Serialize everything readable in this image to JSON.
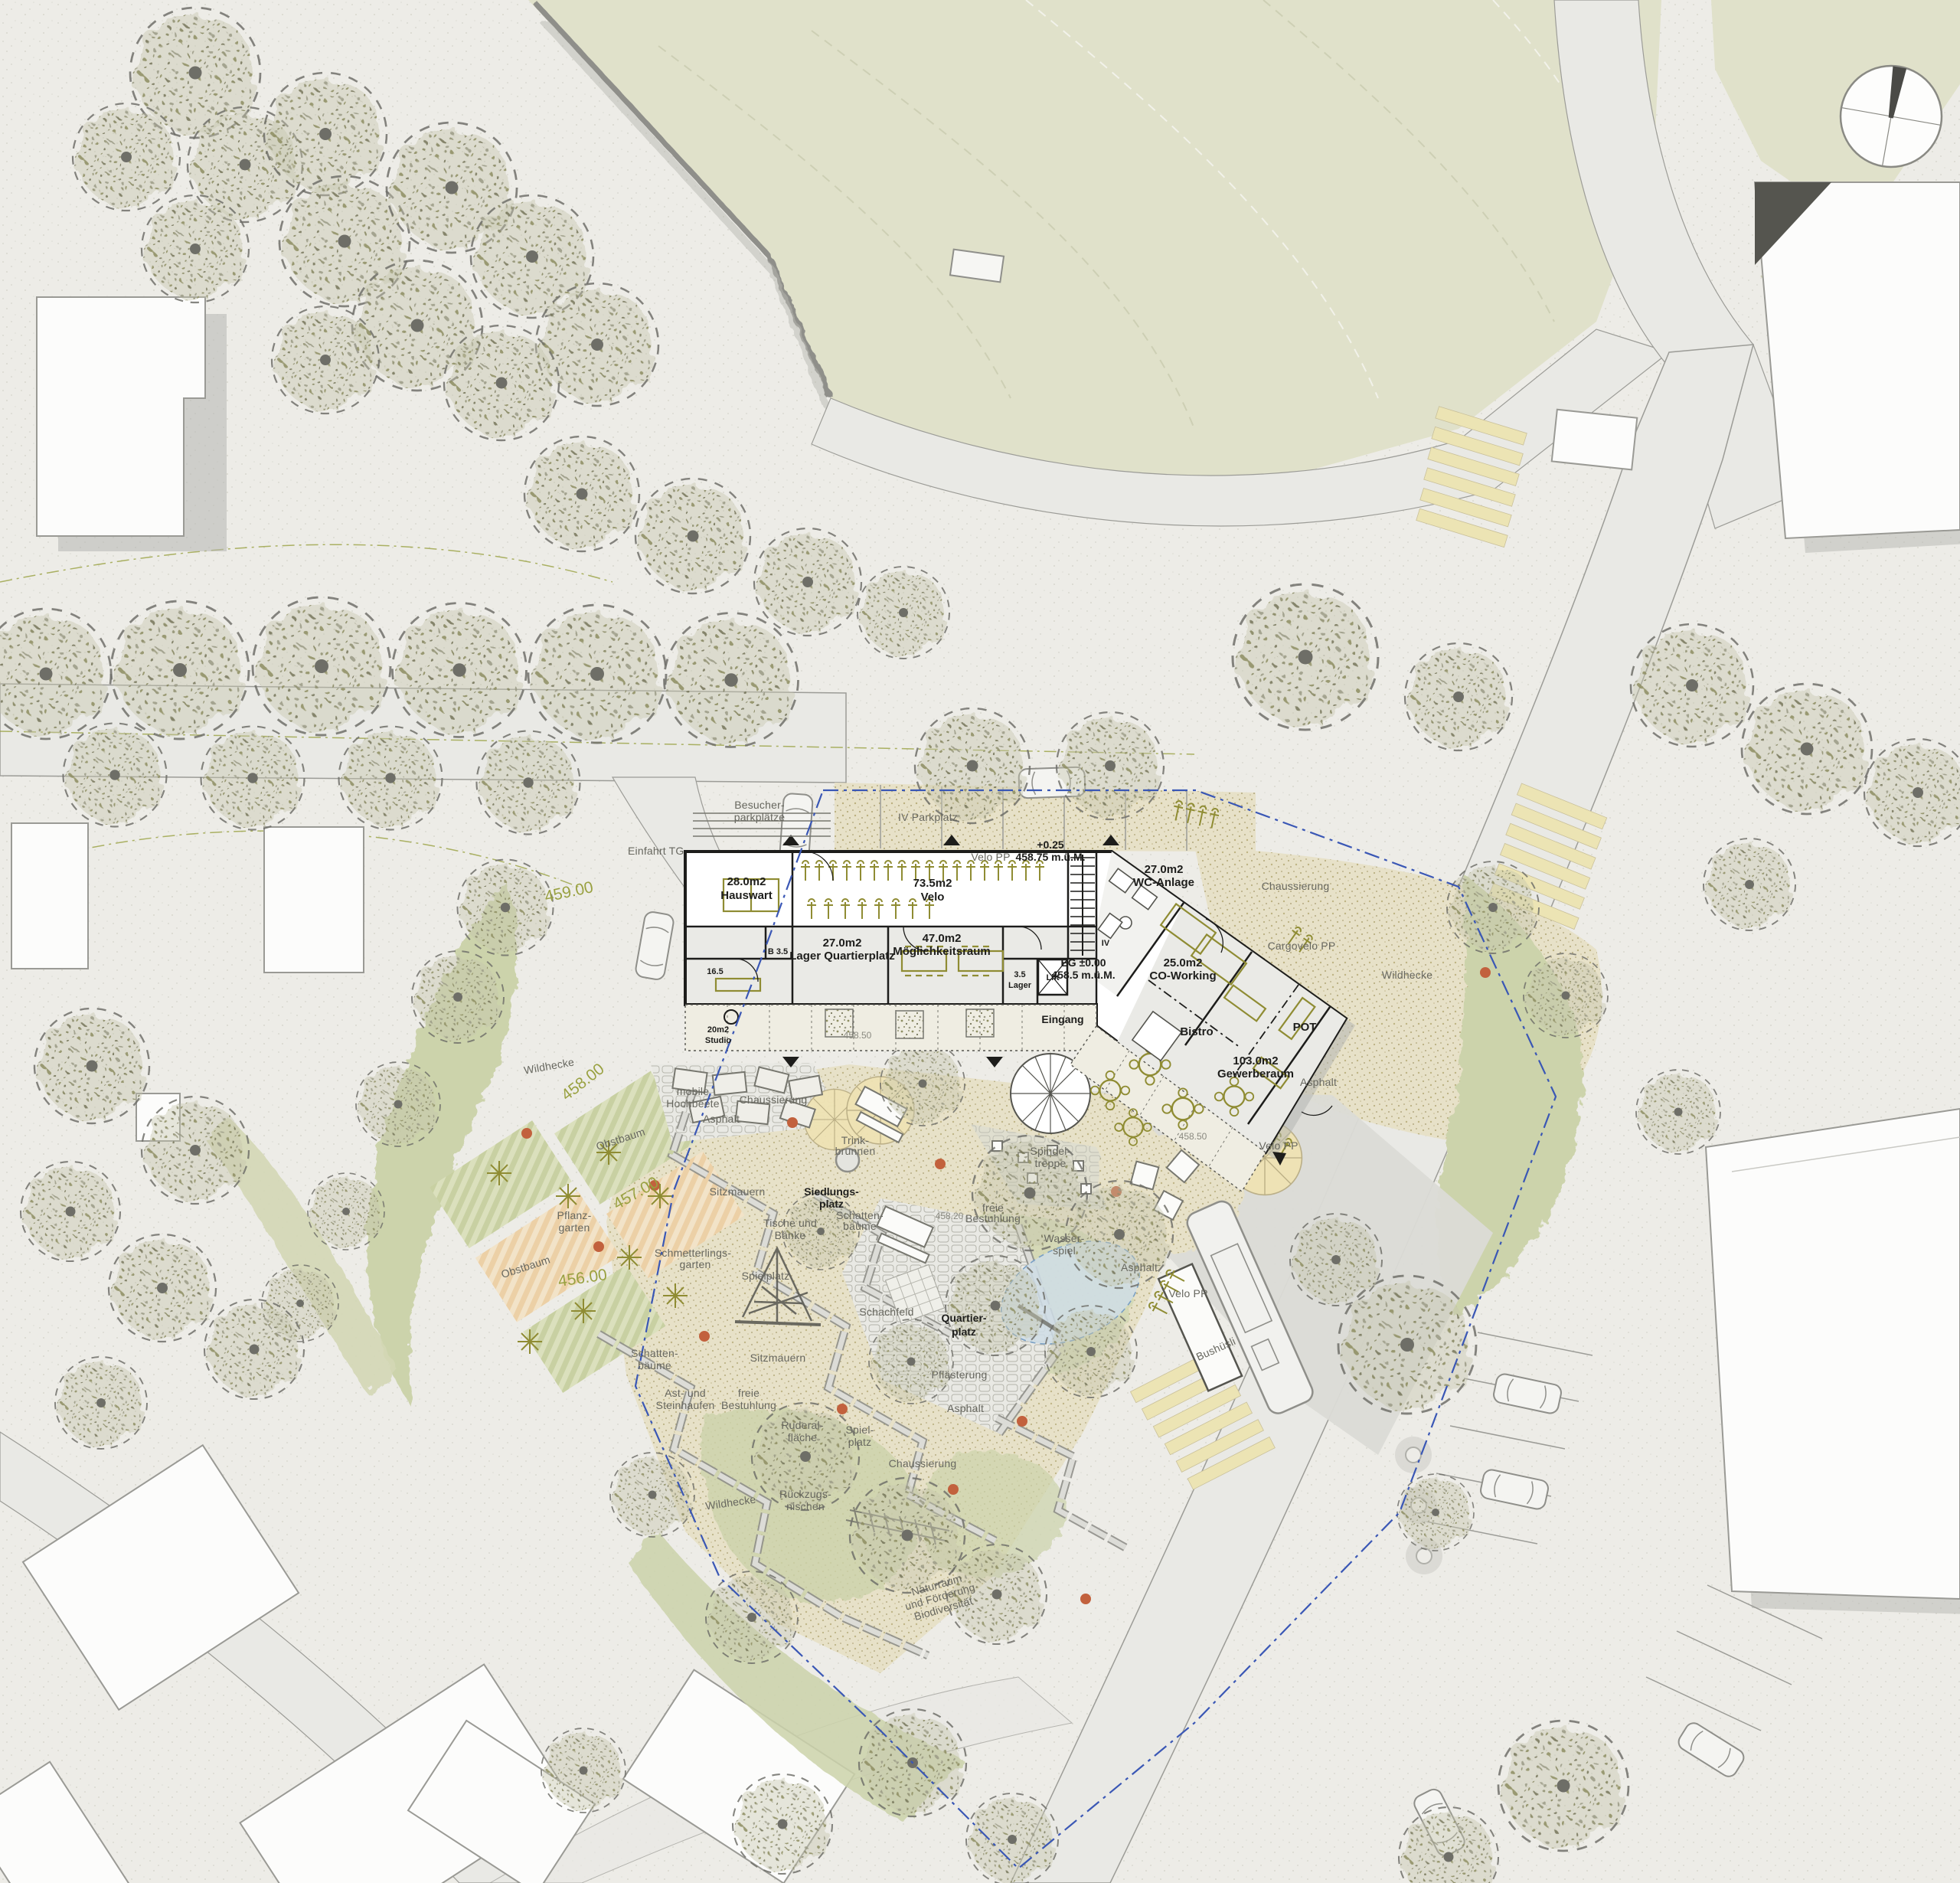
{
  "plan": {
    "icons": {
      "north_arrow": "north-arrow-compass",
      "bus": "bus-top-view",
      "car": "car-top-view",
      "tree": "tree-canopy",
      "parasol": "parasol-umbrella"
    },
    "rooms": {
      "hauswart_area": "28.0m2",
      "hauswart": "Hauswart",
      "velo_area": "73.5m2",
      "velo": "Velo",
      "wc_area": "27.0m2",
      "wc": "WC-Anlage",
      "iv": "IV",
      "lagerq_area": "27.0m2",
      "lagerq": "Lager Quartierplatz",
      "moegl_area": "47.0m2",
      "moegl": "Möglichkeitsraum",
      "bad": "B 3.5",
      "zimmer": "16.5",
      "lager_area": "3.5",
      "lager": "Lager",
      "lift": "Lift",
      "cowork_area": "25.0m2",
      "cowork": "CO-Working",
      "bistro": "Bistro",
      "gewerbe_area": "103.0m2",
      "gewerbe": "Gewerberaum",
      "pot": "POT",
      "studio_area": "20m2",
      "studio": "Studio",
      "eingang": "Eingang",
      "spindel_1": "Spindel-",
      "spindel_2": "treppe",
      "eg_1": "EG ±0.00",
      "eg_2": "458.5 m.ü.M.",
      "entry_1": "+0.25",
      "entry_2": "458.75 m.ü.M."
    },
    "site": {
      "einfahrt_tg": "Einfahrt TG",
      "besucher_1": "Besucher-",
      "besucher_2": "parkplätze",
      "iv_parkplatz": "IV Parkplatz",
      "velo_pp_nord": "Velo PP",
      "velo_pp_ost": "Velo PP",
      "velo_pp_bus": "Velo PP",
      "cargovelo": "Cargovelo PP",
      "bushuesli": "Bushüsli",
      "chaussierung_no": "Chaussierung",
      "chaussierung_w": "Chaussierung",
      "chaussierung_s": "Chaussierung",
      "asphalt_o": "Asphalt",
      "asphalt_w": "Asphalt",
      "asphalt_m": "Asphalt",
      "asphalt_s": "Asphalt",
      "pflaesterung": "Pflästerung",
      "wildhecke_w": "Wildhecke",
      "wildhecke_o": "Wildhecke",
      "wildhecke_s": "Wildhecke",
      "hochbeete_1": "mobile",
      "hochbeete_2": "Hochbeete",
      "obstbaum_1": "Obstbaum",
      "obstbaum_2": "Obstbaum",
      "pflanzgarten_1": "Pflanz-",
      "pflanzgarten_2": "garten",
      "sitzmauern_1": "Sitzmauern",
      "sitzmauern_2": "Sitzmauern",
      "siedlungsplatz_1": "Siedlungs-",
      "siedlungsplatz_2": "platz",
      "tische_1": "Tische und",
      "tische_2": "Bänke",
      "schattenb_1a": "Schatten-",
      "schattenb_1b": "bäume",
      "schattenb_2a": "Schatten-",
      "schattenb_2b": "bäume",
      "schmett_1": "Schmetterlings-",
      "schmett_2": "garten",
      "spielplatz": "Spielplatz",
      "spielplatz2_1": "Spiel-",
      "spielplatz2_2": "platz",
      "schachfeld": "Schachfeld",
      "quartier_1": "Quartier-",
      "quartier_2": "platz",
      "frei_1a": "freie",
      "frei_1b": "Bestuhlung",
      "frei_2a": "freie",
      "frei_2b": "Bestuhlung",
      "ruderal_1": "Ruderal-",
      "ruderal_2": "fläche",
      "rueckzug_1": "Rückzugs-",
      "rueckzug_2": "nischen",
      "ast_1": "Ast- und",
      "ast_2": "Steinhaufen",
      "natur_1": "Naturraum",
      "natur_2": "und Förderung",
      "natur_3": "Biodiversität",
      "trink_1": "Trink-",
      "trink_2": "brunnen",
      "wasser_1": "Wasser-",
      "wasser_2": "spiel"
    },
    "elevations": {
      "c459": "459.00",
      "c458": "458.00",
      "c457": "457.00",
      "c456": "456.00",
      "p458_50a": "458.50",
      "p458_50b": "458.50",
      "p458_20": "458.20"
    },
    "colors": {
      "background": "#edece7",
      "park_green": "#e0e1ca",
      "road_fill": "#e9e9e5",
      "road_edge": "#9c9c97",
      "building_white": "#fcfcfb",
      "shadow_gray": "#b5b6b2",
      "plan_wall": "#1d1d1b",
      "furniture_olive": "#8f8c33",
      "sand": "#e7e1c8",
      "lawn": "#d2d8b4",
      "hedge": "#ccd3ab",
      "stone_wall": "#dcdcd7",
      "water": "#cfdde6",
      "boundary_blue": "#3a57b5",
      "contour_olive": "#99a141",
      "label_gray": "#67675f",
      "tree_marker_red": "#c2613d",
      "zebra_yellow": "#ece4b4"
    }
  }
}
